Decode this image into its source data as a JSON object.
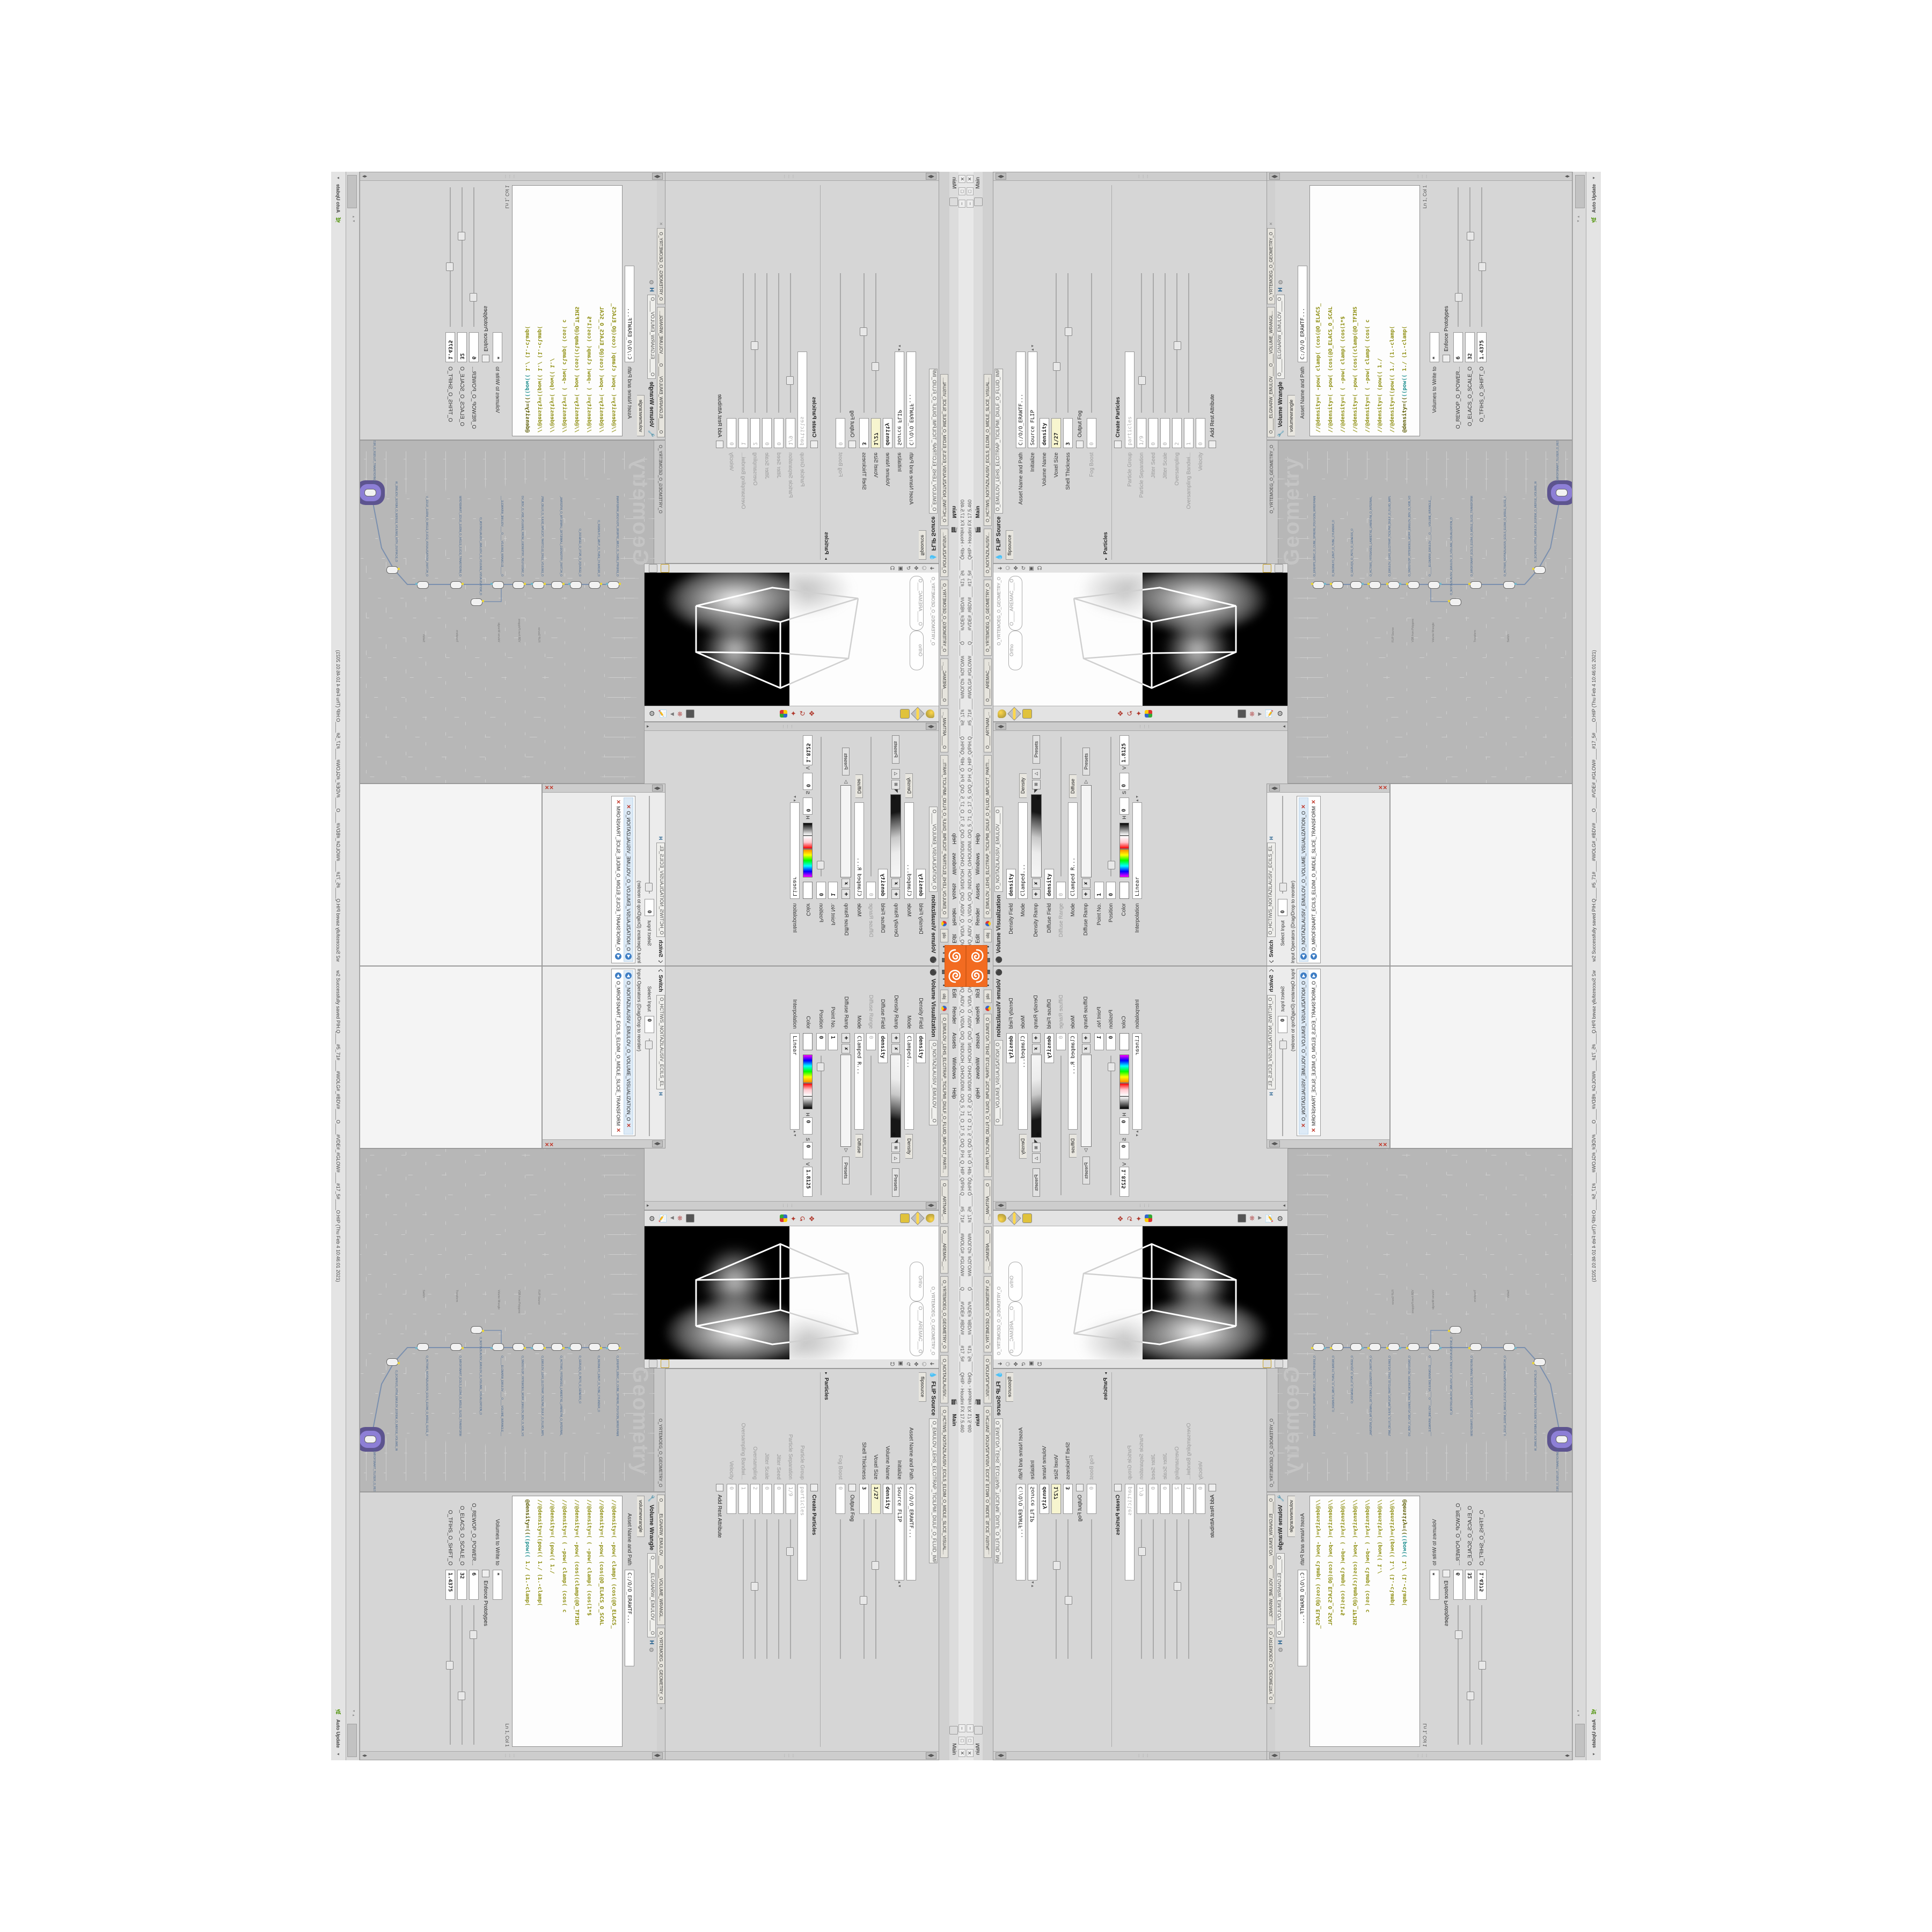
{
  "app": {
    "title": "C:/O/Q_AIDV_Q_VIDIA_O/Q_INIDUOH_O/HOUDINI..O/Q_5_71_O_17_5_O/Q_P.H_Q_HIP_Q/PIH.Q____#5_71#____#WOLG#_#GLOW#____Q____#VDE#_#BDV#____#17_5#____QHIP - Houdini FX 17.5.460",
    "menu": [
      "File",
      "Edit",
      "Render",
      "Assets",
      "Windows",
      "Help"
    ],
    "desktop_tab": "Main",
    "status": "w2 Successfully saved PIH.Q____#5_71#____#WOLG#_#BDV#____O____#VDE#_#GLOW#____#17_5#____O:HIP (Thu Feb 4 10:46:01 2021)",
    "auto_update": "Auto Update",
    "accent_color": "#f26b21"
  },
  "tabs": {
    "flip_long": "O_EMULOV_LEHS_ELCITRAP_TICILPMI_DIULF_O_FLUID_IMPLICIT_PARTI...",
    "mantra": "O____ARTNAM_...",
    "camera": "O____AREMAC__...",
    "obj": "obj",
    "geometry": "O_YRTEMOEG_O_GEOMETRY_O",
    "visualization": "O_NOITAZILAUSIV...",
    "slice_visual": "O_HCTIWS_NOITAZILAUSIV_ECILS_ELDIM_O_MIDLE_SLICE_VISUAL..."
  },
  "flip": {
    "header": "FLIP Source",
    "path": "O_EMULOV_LEHS_ELCITRAP_TICILPMI_DIULF_O_FLUID_IMPLICIT_PARTI...",
    "tab": "flipsource",
    "asset_label": "Asset Name and Path",
    "asset_value": "C:/O/O_ERAWTF...",
    "initialize_label": "Initialize",
    "initialize_value": "Source FLIP",
    "volume_name_label": "Volume Name",
    "volume_name_value": "density",
    "voxel_size_label": "Voxel Size",
    "voxel_size_value": "1/27",
    "shell_label": "Shell Thickness",
    "shell_value": "3",
    "output_fog_label": "Output Fog",
    "fog_boost_label": "Fog Boost",
    "fog_boost_value": "0",
    "particles_section": "Particles",
    "create_particles_label": "Create Particles",
    "particle_group_label": "Particle Group",
    "particle_group_value": "particles",
    "particle_sep_label": "Particle Separation",
    "particle_sep_value": "1/9",
    "jitter_seed_label": "Jitter Seed",
    "jitter_seed_value": "0",
    "jitter_scale_label": "Jitter Scale",
    "jitter_scale_value": "0",
    "oversampling_label": "Oversampling",
    "oversampling_value": "2",
    "oversampling_bw_label": "Oversampling Bandwi...",
    "oversampling_bw_value": "1",
    "velocity_label": "Velocity",
    "velocity_value": "0",
    "add_rest_label": "Add Rest Attribute"
  },
  "wrangle": {
    "header": "Volume Wrangle",
    "path": "O_____ELGNARW_EMULOV____O",
    "tab_long1": "O_____ELGNARW_EMULOV____O____VOLUME_WRANGL...",
    "tab_long2": "O_YRTEMOEG_O_GEOMETRY_O",
    "tab": "volumewrangle",
    "asset_label": "Asset Name and Path",
    "asset_value": "C:/O/O_ERAWTF...",
    "code_lines": [
      "//@density=(  -pow(  clamp(  (cos(@O_ELACS_",
      "//@density=(  -pow(   (cos(@O_ELACS_O_SCAL",
      "//@density=( ( -pow(  clamp(  (cos(1*$",
      "//@density=(  -pow(  (cos((clamp(@O_TFIHS",
      "//@density=( ( -pow(  clamp(  (cos( c",
      "//@density=(     (pow((        1./",
      "//@density=((pow((  1./ (1.-clamp("
    ],
    "final_a": "@density=((",
    "final_b": "((pow((",
    "final_c": "  1./ (1.-clamp(",
    "cursor": "Ln 1, Col 1",
    "volumes_label": "Volumes to Write to",
    "volumes_value": "*",
    "enforce_label": "Enforce Prototypes",
    "spare1_label": "O_REWOP_O_POWER...",
    "spare1_value": "6",
    "spare2_label": "O_ELACS_O_SCALE_O",
    "spare2_value": "32",
    "spare3_label": "O_TFIHS_O_SHIFT_O",
    "spare3_value": "1.4375"
  },
  "volviz": {
    "header": "Volume Visualization",
    "path": "O_NOITAZILAUSIV_EMULOV____O",
    "density_field_label": "Density Field",
    "density_field_value": "density",
    "mode1_label": "Mode",
    "mode1_value": "Clamped...",
    "ramp_tab1": "Density",
    "density_ramp_label": "Density Ramp",
    "diffuse_field_label": "Diffuse Field",
    "diffuse_field_value": "density",
    "diffuse_range_label": "Diffuse Range",
    "diffuse_range_value": "0",
    "mode2_label": "Mode",
    "mode2_value": "Clamped R...",
    "ramp_tab2": "Diffuse",
    "diffuse_ramp_label": "Diffuse Ramp",
    "point_label": "Point No.",
    "point_value": "1",
    "position_label": "Position",
    "position_value": "0",
    "color_label": "Color",
    "h_label": "H",
    "h_value": "0",
    "s_label": "S",
    "s_value": "0",
    "v_label": "V",
    "v_value": "1.8125",
    "interp_label": "Interpolation",
    "interp_value": "Linear",
    "presets_label": "Presets"
  },
  "switcher": {
    "header": "Switch",
    "path": "O_HCTIWS_NOITAZILAUSIV_ECILS_EL",
    "select_label": "Select Input",
    "select_value": "0",
    "list_label": "Input Operators (Drag/Drop to reorder)",
    "item1": "O_NOITAZILAUSIV_EMULOV_O_VOLUME_VISUALIZATION_O",
    "item2": "O_MROFSNART_ECILS_ELDIM_O_MIDLE_SLICE_TRANSFORM_O"
  },
  "network": {
    "context_tab": "obj",
    "path": "O_YRTEMOEG_O_GEOMETRY_O",
    "watermark": "Geometry",
    "nodes": [
      {
        "name": "O_EREHPS_EBUC_O_CUBE_SPHERE_POLYGON_WIREFRAME_O",
        "type": "Sphere"
      },
      {
        "name": "O_REDNILYC_EBUT_O_TUBE_CYLINDER_O",
        "type": "Tube"
      },
      {
        "name": "O_GERUQS_O_PETS_O_GENESIS_O",
        "type": "Box"
      },
      {
        "name": "O_HCTIWS_YRTEMOEG_LANRETXE_LANRETNI_O_INTERNAL_EXTERNAL_GEOMETRY_SWITCH_O",
        "type": "Switch"
      },
      {
        "name": "O_EMULOV_LEHS_ELCITRAP_TICILPMI_DIULF_O_FLUID_IMPLICIT_PARTICLE_SHEL_VOLUME_O",
        "type": "FLIP Source"
      },
      {
        "name": "O_SNOGYLOP_YRTEMOEG_MORF_EMULOV_BDV_O_VDB_VOLUME_FROM_GEOMETRY_POLYGONS_O",
        "type": "VDB from Polygons"
      },
      {
        "name": "O_____ELGNARW_EMULOV____O____VOLUME_WRANGLE____O2",
        "type": "Volume Wrangle"
      },
      {
        "name": "O_NOITAZILAUSIV_EMULOV_O_VOLUME_VISUALIZATION_O",
        "type": "Volume Visualization"
      },
      {
        "name": "O_MROFSNART_ECILS_ELDIM_O_MIDLE_SLICE_TRANSFORM_O",
        "type": "Transform"
      },
      {
        "name": "O_HCTIWS_NOITAZILAUSIV_ECILS_ELDIM_O_MIDLE_SLICE_VISUALIZATION_SWITCH_O",
        "type": "Switch"
      },
      {
        "name": "O_ECAFRUS_HTIW_EMULOV_EGREM_O_MERGE_VOLUME_WITH_SURFACE_O",
        "type": "Merge"
      },
      {
        "name": "O_MROFSNART_TLUSER_O_RESULT_TRANSFORM_O",
        "type": "Transform"
      }
    ]
  },
  "viewport": {
    "camera_pill": "O____AREMAC___O",
    "ortho_pill": "Ortho",
    "geometry_label": "O_YRTEMOEG_O_GEOMETRY_O"
  }
}
